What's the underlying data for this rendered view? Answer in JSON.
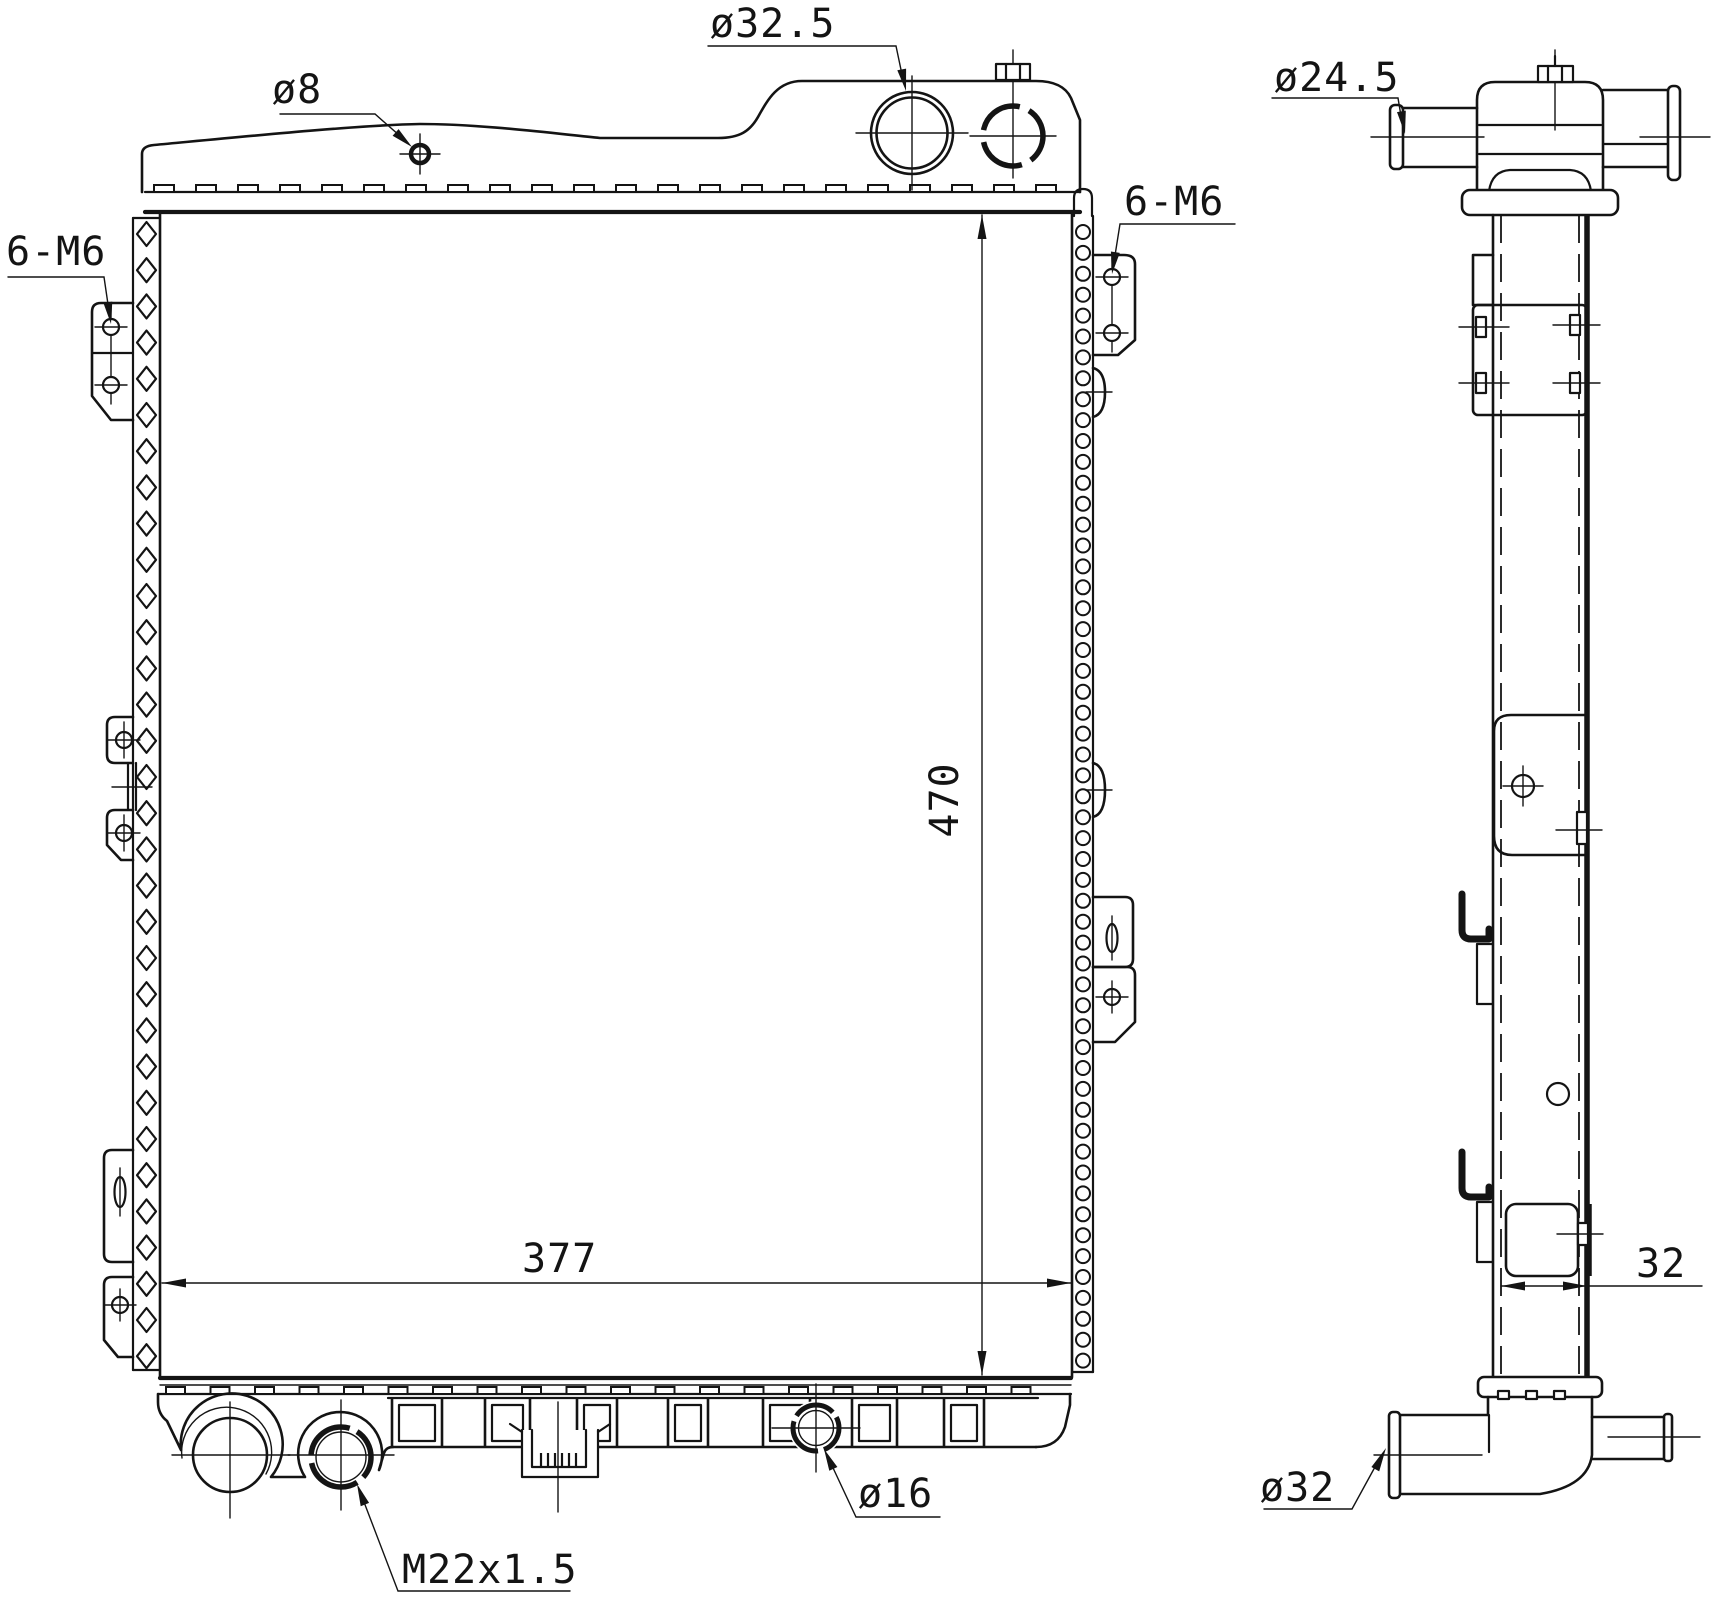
{
  "drawing_title": "radiator-engineering-drawing",
  "colors": {
    "line": "#141414",
    "background": "#ffffff"
  },
  "front_view": {
    "labels": {
      "top_hole": "ø8",
      "filler_neck": "ø32.5",
      "mount_left": "6-M6",
      "mount_right": "6-M6",
      "drain_plug": "M22x1.5",
      "outlet_small": "ø16"
    },
    "dimensions": {
      "core_width": "377",
      "core_height": "470"
    }
  },
  "side_view": {
    "labels": {
      "inlet_pipe": "ø24.5",
      "outlet_pipe": "ø32"
    },
    "dimensions": {
      "core_depth": "32"
    }
  }
}
